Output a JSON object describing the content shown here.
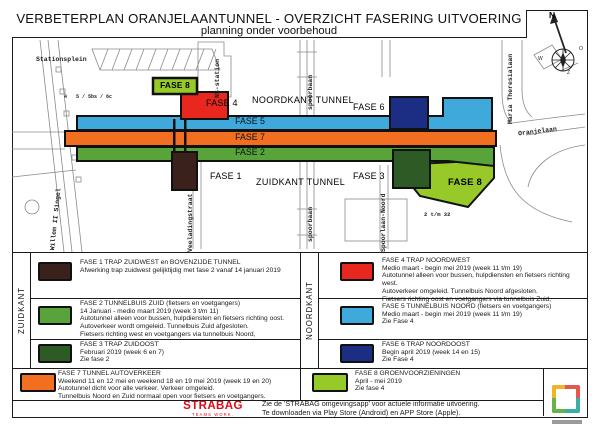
{
  "title": "VERBETERPLAN ORANJELAANTUNNEL - OVERZICHT FASERING UITVOERING",
  "subtitle": "planning onder voorbehoud",
  "compass": {
    "north": "N",
    "west": "W",
    "east": "O",
    "south": "Z"
  },
  "map": {
    "streets": {
      "stationsplein": "Stationsplein",
      "ns_station": "NS-station",
      "spoorbaan_noord": "spoorbaan",
      "spoorbaan_zuid": "spoorbaan",
      "willem_ii_singel": "Willem II Singel",
      "veeladingstraat": "Veeladingstraat",
      "spoorlaan_noord": "Spoorlaan-Noord",
      "maria_theresialaan": "Maria Theresialaan",
      "oranjelaan": "Oranjelaan"
    },
    "small_labels": {
      "huisnr_links_1": "4",
      "huisnr_links_2": "5 / 5bs / 6c",
      "huisnr_rechts": "2 t/m 32"
    },
    "areas": {
      "noordkant_tunnel": "NOORDKANT TUNNEL",
      "zuidkant_tunnel": "ZUIDKANT TUNNEL"
    },
    "phase_labels": {
      "fase1": "FASE 1",
      "fase2": "FASE 2",
      "fase3": "FASE 3",
      "fase4": "FASE 4",
      "fase5": "FASE 5",
      "fase6": "FASE 6",
      "fase7": "FASE 7",
      "fase8_noord": "FASE 8",
      "fase8_zuid": "FASE 8"
    }
  },
  "legend": {
    "groups": {
      "zuidkant": "ZUIDKANT",
      "noordkant": "NOORDKANT"
    },
    "entries": [
      {
        "id": "fase1",
        "color": "#3b211c",
        "title": "FASE 1 TRAP ZUIDWEST en BOVENZIJDE TUNNEL",
        "lines": [
          "Afwerking trap zuidwest gelijktijdig met fase 2 vanaf 14 januari 2019"
        ]
      },
      {
        "id": "fase2",
        "color": "#58a33a",
        "title": "FASE 2 TUNNELBUIS ZUID (fietsers en voetgangers)",
        "lines": [
          "14 Januari - medio maart 2019 (week 3 t/m 11)",
          "Autotunnel alleen voor bussen, hulpdiensten en fietsers richting oost.",
          "Autoverkeer wordt omgeleid. Tunnelbuis Zuid afgesloten.",
          "Fietsers richting west en voetgangers via tunnelbuis Noord,"
        ]
      },
      {
        "id": "fase3",
        "color": "#2e5b25",
        "title": "FASE 3 TRAP ZUIDOOST",
        "lines": [
          "Februari 2019 (week 6 en 7)",
          "Zie fase 2"
        ]
      },
      {
        "id": "fase7",
        "color": "#f26f21",
        "title": "FASE 7 TUNNEL AUTOVERKEER",
        "lines": [
          "Weekend 11 en 12 mei en weekend 18 en 19 mei 2019 (week 19 en 20)",
          "Autotunnel dicht voor alle verkeer. Verkeer omgeleid.",
          "Tunnelbuis Noord en Zuid normaal open voor fietsers en voetgangers."
        ]
      },
      {
        "id": "fase4",
        "color": "#e8271f",
        "title": "FASE 4 TRAP NOORDWEST",
        "lines": [
          "Medio maart - begin mei 2019 (week 11 t/m 19)",
          "Autotunnel alleen voor bussen, hulpdiensten en fietsers richting west.",
          "Autoverkeer omgeleid. Tunnelbuis Noord afgesloten.",
          "Fietsers richting oost en voetgangers via tunnelbuis Zuid,"
        ]
      },
      {
        "id": "fase5",
        "color": "#3fa9dc",
        "title": "FASE 5 TUNNELBUIS NOORD (fietsers en voetgangers)",
        "lines": [
          "Medio maart - begin mei 2019 (week 11 t/m 19)",
          "Zie Fase 4"
        ]
      },
      {
        "id": "fase6",
        "color": "#1b2e83",
        "title": "FASE 6 TRAP NOORDOOST",
        "lines": [
          "Begin april 2019 (week 14 en 15)",
          "Zie Fase 4"
        ]
      },
      {
        "id": "fase8",
        "color": "#97ca28",
        "title": "FASE 8 GROENVOORZIENINGEN",
        "lines": [
          "April - mei 2019",
          "Zie fase 4"
        ]
      }
    ]
  },
  "footer": {
    "brand": "STRABAG",
    "brand_tagline": "TEAMS WORK.",
    "note_lines": [
      "Zie de 'STRABAG omgevingsapp' voor actuele informatie uitvoering.",
      "Te downloaden via Play Store (Android) en APP Store (Apple)."
    ]
  },
  "colors": {
    "logo_yellow": "#f0b429",
    "logo_red": "#e4574e",
    "logo_green": "#67b346",
    "logo_teal": "#3cafa4",
    "strabag_red": "#e30613"
  }
}
